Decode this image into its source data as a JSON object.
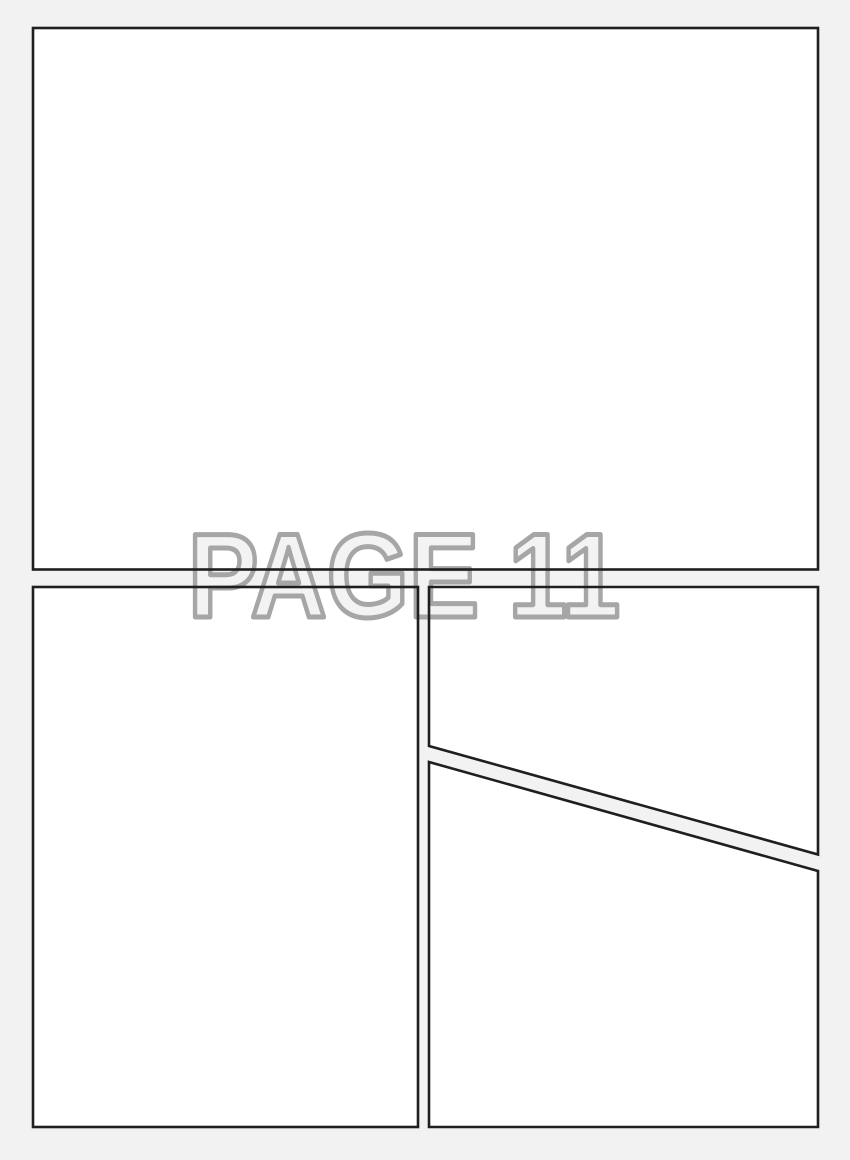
{
  "page": {
    "kind_label": "blank comic page layout",
    "watermark_text": "PAGE 11"
  },
  "colors": {
    "page_background": "#f2f2f2",
    "panel_fill": "#ffffff",
    "panel_border": "#1f1f1f",
    "watermark_fill": "#f3f3f3",
    "watermark_outline": "#a6a6a6"
  },
  "panels": [
    {
      "id": "panel-1",
      "position": "top full-width"
    },
    {
      "id": "panel-2",
      "position": "bottom left"
    },
    {
      "id": "panel-3",
      "position": "bottom right upper (diagonal bottom edge)"
    },
    {
      "id": "panel-4",
      "position": "bottom right lower (diagonal top edge)"
    }
  ]
}
